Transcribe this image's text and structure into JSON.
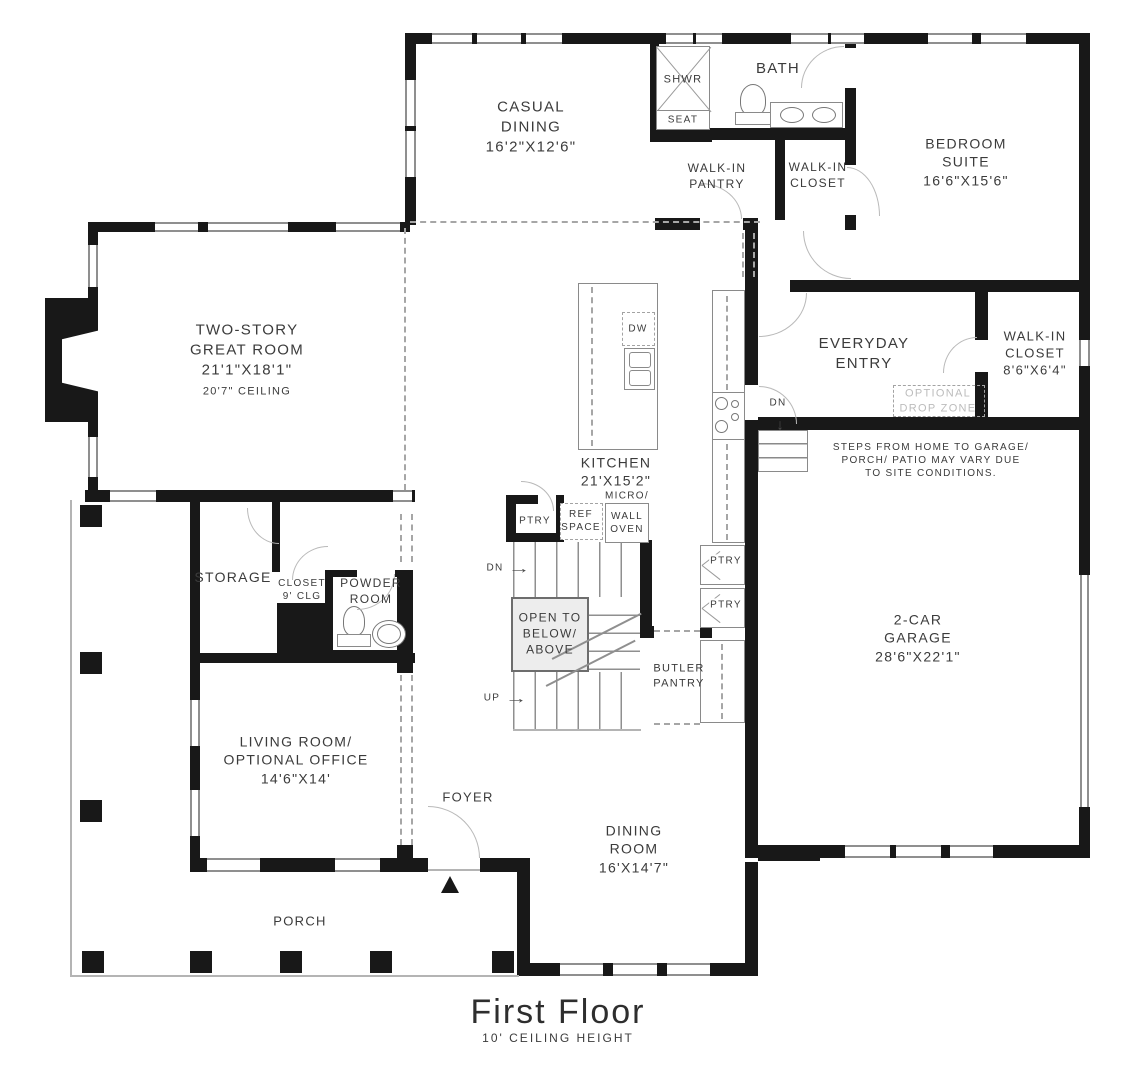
{
  "title": {
    "main": "First Floor",
    "subtitle": "10' CEILING HEIGHT"
  },
  "rooms": {
    "casual_dining": "CASUAL\nDINING\n16'2\"X12'6\"",
    "bath": "BATH",
    "shwr": "SHWR",
    "seat": "SEAT",
    "walk_in_pantry": "WALK-IN\nPANTRY",
    "walk_in_closet_upper": "WALK-IN\nCLOSET",
    "bedroom_suite": "BEDROOM\nSUITE\n16'6\"X15'6\"",
    "great_room": "TWO-STORY\nGREAT ROOM\n21'1\"X18'1\"",
    "great_room_ceiling": "20'7\" CEILING",
    "kitchen": "KITCHEN\n21'X15'2\"",
    "everyday_entry": "EVERYDAY\nENTRY",
    "optional_drop_zone": "OPTIONAL\nDROP ZONE",
    "walk_in_closet_garage": "WALK-IN\nCLOSET\n8'6\"X6'4\"",
    "garage": "2-CAR\nGARAGE\n28'6\"X22'1\"",
    "storage": "STORAGE",
    "closet": "CLOSET\n9' CLG",
    "powder_room": "POWDER\nROOM",
    "living_room": "LIVING ROOM/\nOPTIONAL OFFICE\n14'6\"X14'",
    "foyer": "FOYER",
    "dining_room": "DINING\nROOM\n16'X14'7\"",
    "porch": "PORCH",
    "butler_pantry": "BUTLER\nPANTRY",
    "open_to": "OPEN TO\nBELOW/\nABOVE"
  },
  "fixtures": {
    "dw": "DW",
    "ref_space": "REF\nSPACE",
    "micro": "MICRO/",
    "wall_oven": "WALL\nOVEN",
    "ptry_stairs": "PTRY",
    "ptry_1": "PTRY",
    "ptry_2": "PTRY"
  },
  "annotations": {
    "steps_note": "STEPS FROM HOME TO GARAGE/\nPORCH/ PATIO MAY VARY DUE\nTO SITE CONDITIONS.",
    "dn": "DN",
    "up": "UP",
    "dn_garage": "DN",
    "arrow_right": "→",
    "arrow_down": "↓"
  },
  "colors": {
    "wall": "#181818",
    "line": "#8f8f8f",
    "text": "#3b3b3b",
    "muted": "#bcbcbc"
  }
}
